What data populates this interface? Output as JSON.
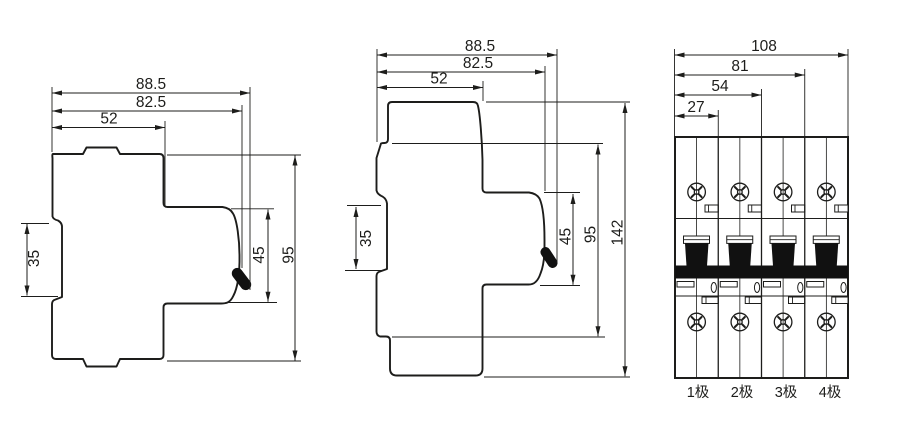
{
  "figure": {
    "type": "technical-dimension-drawing",
    "background": "#ffffff",
    "line_color": "#1d1d1b",
    "handle_fill": "#111111"
  },
  "side_view_95": {
    "dims": {
      "overall_width": "88.5",
      "body_width": "82.5",
      "upper_width": "52",
      "din_rail_slot": "35",
      "front_section_height": "45",
      "overall_height": "95"
    }
  },
  "side_view_142": {
    "dims": {
      "overall_width": "88.5",
      "body_width": "82.5",
      "upper_width": "52",
      "din_rail_slot": "35",
      "front_section_height": "45",
      "body_height": "95",
      "overall_height": "142"
    }
  },
  "front_view": {
    "dims": {
      "width_4_pole": "108",
      "width_3_pole": "81",
      "width_2_pole": "54",
      "width_1_pole": "27"
    },
    "pole_labels": [
      "1极",
      "2极",
      "3极",
      "4极"
    ]
  }
}
